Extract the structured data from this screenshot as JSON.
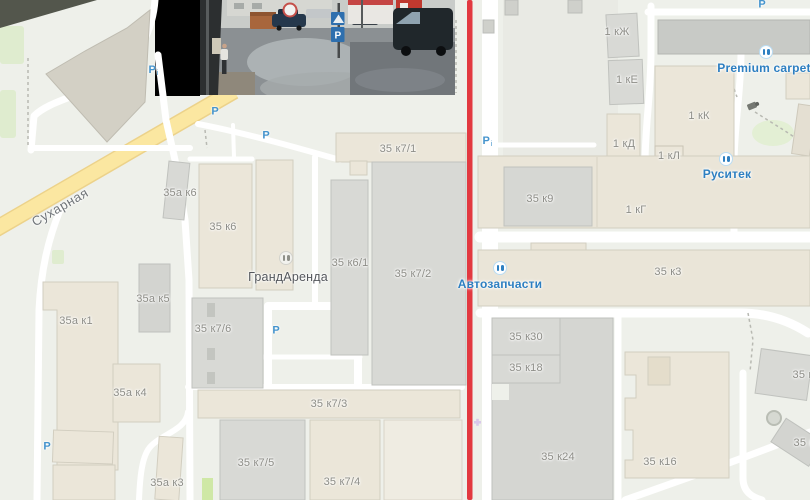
{
  "street": "Сухарная",
  "buildings": [
    "35а к6",
    "35 к6",
    "35 к7/1",
    "35 к6/1",
    "35 к7/2",
    "35а к5",
    "35а к1",
    "35 к7/6",
    "35а к4",
    "35 к7/3",
    "35 к7/5",
    "35 к7/4",
    "35а к3",
    "1 кЖ",
    "1 кЕ",
    "1 кК",
    "1 кД",
    "1 кЛ",
    "1 кГ",
    "35 к9",
    "35 к3",
    "35 к30",
    "35 к18",
    "35 к24",
    "35 к16",
    "35 к",
    "35 к"
  ],
  "pois": {
    "grandarenda": "ГрандАренда",
    "premium_carpet": "Premium carpet",
    "rusitek": "Руситек",
    "autoparts": "Автозапчасти"
  },
  "parking_label": "P",
  "parking_sub": "i",
  "photo": {
    "parking_sign": "P"
  },
  "route_color": "#e23940",
  "colors": {
    "poi_blue": "#2d7fc1",
    "building_label_gray": "#8d8d87",
    "road_yellow": "#fbe195",
    "building_beige": "#ebe6d9",
    "building_gray": "#d8d9d5"
  }
}
